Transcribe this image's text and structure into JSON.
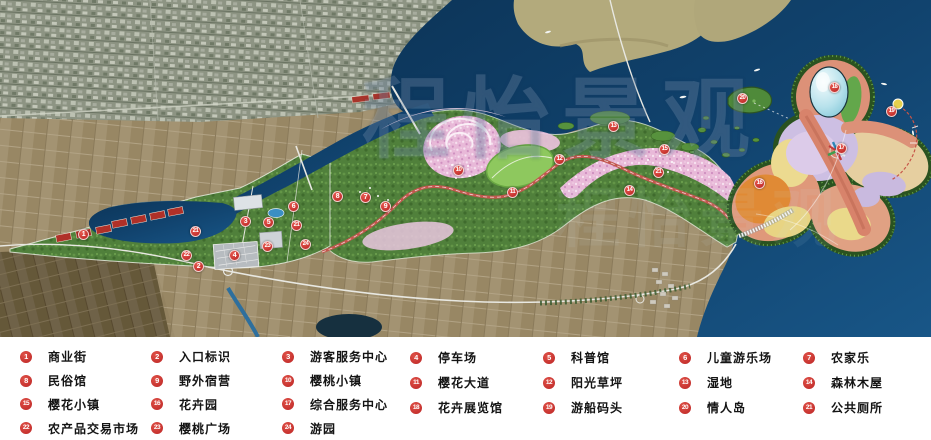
{
  "watermark": "程怡景观",
  "map": {
    "colors": {
      "water": "#0f3e66",
      "water_light": "#1a5584",
      "khaki_land": "#b3aa7c",
      "park_green": "#4e7d3a",
      "lawn_green": "#8ec85e",
      "blossom_pink": "#eec3e0",
      "road_red": "#c2574e",
      "marker_red": "#bb2424",
      "butterfly_salmon": "#dc9178",
      "butterfly_yellow": "#ecd98e",
      "butterfly_lavender": "#cdbfe3",
      "butterfly_orange": "#e08a35"
    },
    "markers": [
      {
        "id": "1",
        "x": 83,
        "y": 234
      },
      {
        "id": "2",
        "x": 198,
        "y": 266
      },
      {
        "id": "3",
        "x": 245,
        "y": 221
      },
      {
        "id": "4",
        "x": 234,
        "y": 255
      },
      {
        "id": "5",
        "x": 268,
        "y": 222
      },
      {
        "id": "6",
        "x": 293,
        "y": 206
      },
      {
        "id": "7",
        "x": 365,
        "y": 197
      },
      {
        "id": "8",
        "x": 337,
        "y": 196
      },
      {
        "id": "9",
        "x": 385,
        "y": 206
      },
      {
        "id": "10",
        "x": 458,
        "y": 170
      },
      {
        "id": "11",
        "x": 512,
        "y": 192
      },
      {
        "id": "12",
        "x": 559,
        "y": 159
      },
      {
        "id": "13",
        "x": 613,
        "y": 126
      },
      {
        "id": "14",
        "x": 629,
        "y": 190
      },
      {
        "id": "15",
        "x": 664,
        "y": 149
      },
      {
        "id": "16",
        "x": 759,
        "y": 183
      },
      {
        "id": "17",
        "x": 841,
        "y": 148
      },
      {
        "id": "18",
        "x": 834,
        "y": 87
      },
      {
        "id": "19",
        "x": 891,
        "y": 111
      },
      {
        "id": "20",
        "x": 742,
        "y": 98
      },
      {
        "id": "21",
        "x": 658,
        "y": 172
      },
      {
        "id": "21",
        "x": 195,
        "y": 231
      },
      {
        "id": "21",
        "x": 296,
        "y": 225
      },
      {
        "id": "22",
        "x": 186,
        "y": 255
      },
      {
        "id": "23",
        "x": 267,
        "y": 246
      },
      {
        "id": "24",
        "x": 305,
        "y": 244
      }
    ]
  },
  "legend": {
    "columns": [
      {
        "items": [
          {
            "id": "1",
            "label": "商业街"
          },
          {
            "id": "8",
            "label": "民俗馆"
          },
          {
            "id": "15",
            "label": "樱花小镇"
          },
          {
            "id": "22",
            "label": "农产品交易市场"
          }
        ]
      },
      {
        "items": [
          {
            "id": "2",
            "label": "入口标识"
          },
          {
            "id": "9",
            "label": "野外宿营"
          },
          {
            "id": "16",
            "label": "花卉园"
          },
          {
            "id": "23",
            "label": "樱桃广场"
          }
        ]
      },
      {
        "items": [
          {
            "id": "3",
            "label": "游客服务中心"
          },
          {
            "id": "10",
            "label": "樱桃小镇"
          },
          {
            "id": "17",
            "label": "综合服务中心"
          },
          {
            "id": "24",
            "label": "游园"
          }
        ]
      },
      {
        "items": [
          {
            "id": "4",
            "label": "停车场"
          },
          {
            "id": "11",
            "label": "樱花大道"
          },
          {
            "id": "18",
            "label": "花卉展览馆"
          }
        ]
      },
      {
        "items": [
          {
            "id": "5",
            "label": "科普馆"
          },
          {
            "id": "12",
            "label": "阳光草坪"
          },
          {
            "id": "19",
            "label": "游船码头"
          }
        ]
      },
      {
        "items": [
          {
            "id": "6",
            "label": "儿童游乐场"
          },
          {
            "id": "13",
            "label": "湿地"
          },
          {
            "id": "20",
            "label": "情人岛"
          }
        ]
      },
      {
        "items": [
          {
            "id": "7",
            "label": "农家乐"
          },
          {
            "id": "14",
            "label": "森林木屋"
          },
          {
            "id": "21",
            "label": "公共厕所"
          }
        ]
      }
    ]
  }
}
